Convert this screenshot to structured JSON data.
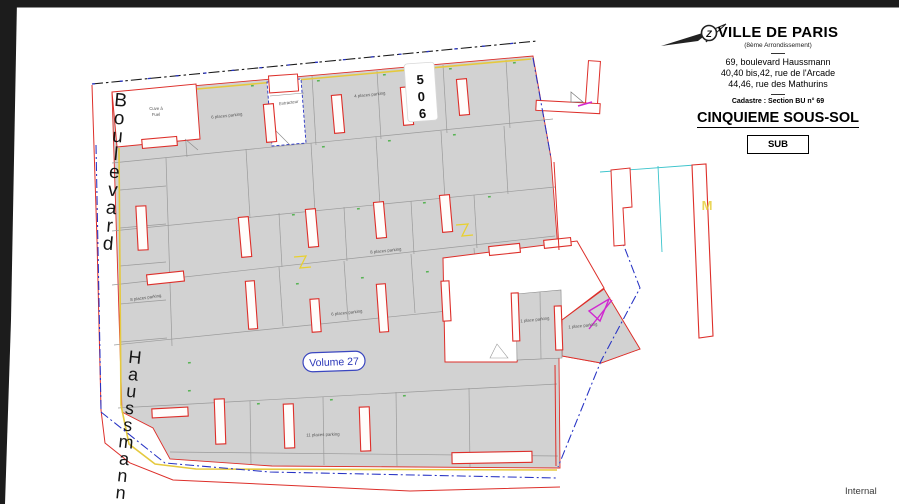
{
  "window": {
    "watermark": "Internal"
  },
  "title_block": {
    "city": "VILLE DE PARIS",
    "district": "(8ème Arrondissement)",
    "address_line1": "69, boulevard Haussmann",
    "address_line2": "40,40 bis,42, rue de l'Arcade",
    "address_line3": "44,46, rue des Mathurins",
    "cadastre": "Cadastre : Section BU n° 69",
    "level_title": "CINQUIEME SOUS-SOL",
    "stamp": "SUB",
    "north_letter": "Z"
  },
  "streets": {
    "name_top": "Boulevard",
    "name_bottom": "Haussmann"
  },
  "plan": {
    "volume_badge": "Volume 27",
    "column_digits": [
      "5",
      "0",
      "6"
    ],
    "metro_marker": "M",
    "rooms": {
      "fuel_line1": "Cuve à",
      "fuel_line2": "Fuel",
      "extractor": "Extracteur"
    },
    "parking_labels": [
      {
        "text": "6 places parking"
      },
      {
        "text": "4 places parking"
      },
      {
        "text": "8 places parking"
      },
      {
        "text": "8 places parking"
      },
      {
        "text": "6 places parking"
      },
      {
        "text": "1 place parking"
      },
      {
        "text": "1 place parking"
      },
      {
        "text": "11 places parking"
      }
    ],
    "colors": {
      "boundary_blue": "#2733c4",
      "parcel_red": "#dd2f2a",
      "volume_yellow": "#e5c93e",
      "metro_cyan": "#3cc4cc",
      "arrow_magenta": "#d028d0",
      "tick_green": "#55b352",
      "slab_gray": "#d2d2d2"
    }
  }
}
